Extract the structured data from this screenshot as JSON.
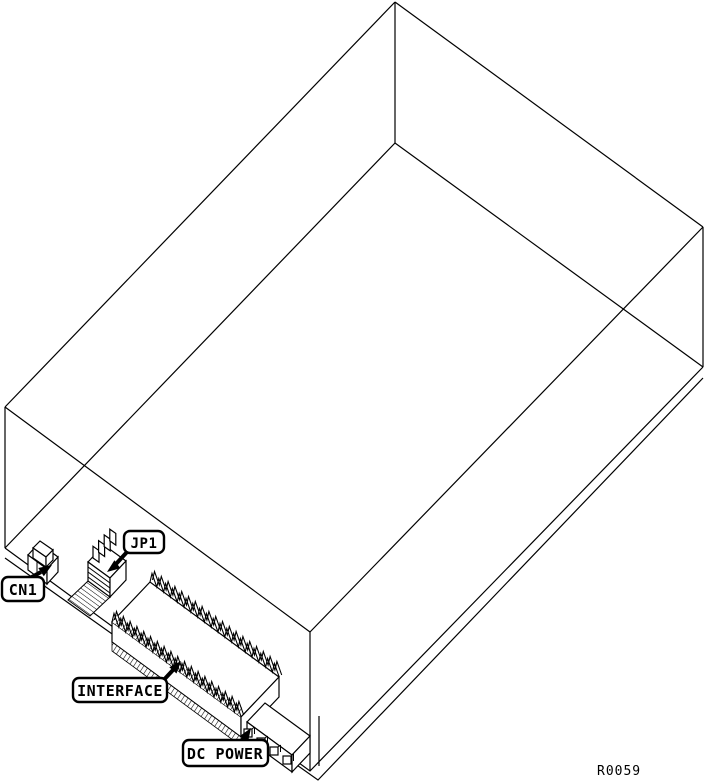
{
  "figure": {
    "callouts": {
      "cn1": "CN1",
      "jp1": "JP1",
      "interface": "INTERFACE",
      "dc_power": "DC POWER"
    },
    "figure_ref": "R0059",
    "colors": {
      "line": "#000000",
      "background": "#ffffff"
    }
  }
}
